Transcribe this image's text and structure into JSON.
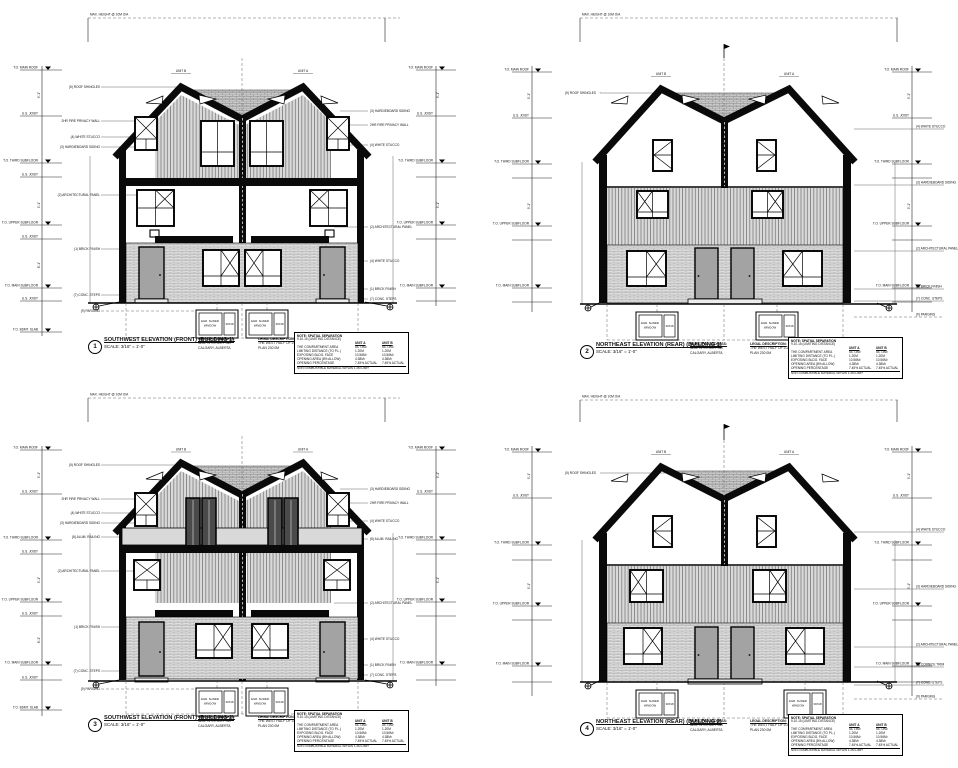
{
  "page": {
    "background": "#ffffff"
  },
  "labels": {
    "max_height": "MAX. HEIGHT @ 10M O/A",
    "unit_a": "UNIT A",
    "unit_b": "UNIT B",
    "to_main_roof": "T.O. MAIN ROOF",
    "us_joist": "U.S. JOIST",
    "to_third": "T.O. THIRD SUBFLOOR",
    "to_upper": "T.O. UPPER SUBFLOOR",
    "to_main": "T.O. MAIN SUBFLOOR",
    "to_bsmt": "T.O. BSMT. SLAB",
    "egress_1": "EGR. SLIDER",
    "egress_2": "WINDOW",
    "egress_size": "30X18",
    "dim_9": "9'-1\"",
    "dim_8": "8'-1\""
  },
  "callouts": {
    "roof_shingles": "(5) ROOF SHINGLES",
    "arch_panel": "(2) ARCHITECTURAL PANEL",
    "white_stucco": "(4) WHITE STUCCO",
    "hardie": "(3) HARDIEBOARD SIDING",
    "privacy_wall": "2HR FIRE PRIVACY WALL",
    "brick": "(1) BRICK FINISH",
    "conc_steps": "(7) CONC. STEPS",
    "parging": "(9) PARGING",
    "cornice": "(6) CORNICE TRIM",
    "railing": "(8) ALUM. RAILING"
  },
  "elevations": [
    {
      "ref": "1",
      "title": "SOUTHWEST ELEVATION (FRONT) (BUILDING 1)",
      "scale": "SCALE: 3/16\" = 1'-0\""
    },
    {
      "ref": "2",
      "title": "NORTHEAST ELEVATION (REAR) (BUILDING 1)",
      "scale": "SCALE: 3/16\" = 1'-0\""
    },
    {
      "ref": "3",
      "title": "SOUTHWEST ELEVATION (FRONT) (BUILDING 2)",
      "scale": "SCALE: 3/16\" = 1'-0\""
    },
    {
      "ref": "4",
      "title": "NORTHEAST ELEVATION (REAR) (BUILDING 2)",
      "scale": "SCALE: 3/16\" = 1'-0\""
    }
  ],
  "address": {
    "heading": "MUNICIPAL ADDRESS:",
    "line1": "4204 75 STREET SW",
    "line2": "CALGARY, ALBERTA"
  },
  "legal": {
    "heading": "LEGAL DESCRIPTION:",
    "line1": "THE WEST HALF OF LOT 2",
    "line2": "PLAN 230 0M"
  },
  "separation": {
    "title": "NOTE: SPATIAL SEPARATION",
    "subtitle": "9.10.15 (LIMITING DISTANCE)",
    "col_a": "UNIT A",
    "col_b": "UNIT B",
    "rows": [
      {
        "label": "THE COMPARTMENT AREA",
        "a": "54.73M²",
        "b": "54.73M²"
      },
      {
        "label": "LIMITING DISTANCE (TO P.L.)",
        "a": "1.20M",
        "b": "1.20M"
      },
      {
        "label": "EXPOSING BLDG. FACE",
        "a": "10.56M²",
        "b": "10.56M²"
      },
      {
        "label": "OPENING AREA (8% ALLOW)",
        "a": "4.38M²",
        "b": "4.38M²"
      },
      {
        "label": "OPENING PERCENTAGE",
        "a": "7.45% ACTUAL",
        "b": "7.45% ACTUAL"
      }
    ],
    "footer": "NON COMBUSTIBLE MATERIAL WITHIN 1.2M LIMIT"
  }
}
